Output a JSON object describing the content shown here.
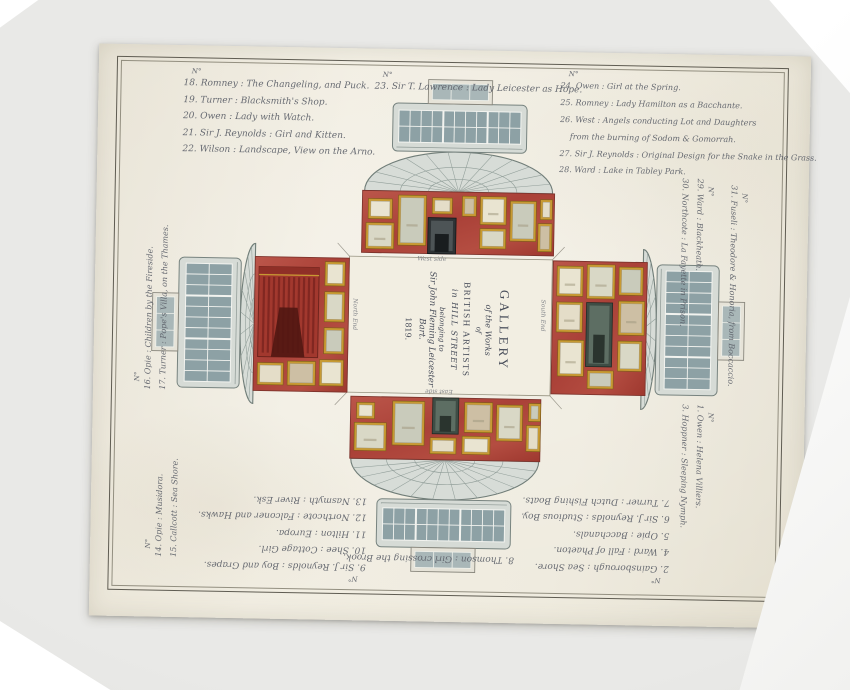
{
  "title": {
    "l1": "GALLERY",
    "l2": "of the Works",
    "l3": "of",
    "l4": "BRITISH ARTISTS",
    "l5": "in HILL STREET",
    "l6": "belonging to",
    "l7": "Sir John Fleming Leicester Bart.",
    "l8": "1819."
  },
  "captions": {
    "west": "West side",
    "east": "East side",
    "north": "North End",
    "south": "South End"
  },
  "catalogue": {
    "top_left": {
      "header": "N°",
      "items": [
        "18. Romney : The Changeling, and Puck.",
        "19. Turner : Blacksmith's Shop.",
        "20. Owen : Lady with Watch.",
        "21. Sir J. Reynolds : Girl and Kitten.",
        "22. Wilson : Landscape, View on the Arno."
      ]
    },
    "top_center": {
      "header": "N°",
      "items": [
        "23. Sir T. Lawrence : Lady Leicester as Hope."
      ]
    },
    "top_right": {
      "header": "N°",
      "items": [
        "24. Owen : Girl at the Spring.",
        "25. Romney : Lady Hamilton as a Bacchante.",
        "26. West : Angels conducting Lot and Daughters",
        "    from the burning of Sodom & Gomorrah.",
        "27. Sir J. Reynolds : Original Design for the Snake in the Grass.",
        "28. Ward : Lake in Tabley Park."
      ]
    },
    "left_upper": {
      "header": "N°",
      "items": [
        "16. Opie : Children by the Fireside.",
        "17. Turner : Pope's Villa, on the Thames."
      ]
    },
    "left_lower": {
      "header": "N°",
      "items": [
        "14. Opie : Musidora.",
        "15. Callcott : Sea Shore."
      ]
    },
    "right_upper": {
      "header": "N°",
      "items": [
        "29. Ward : Blackheath.",
        "30. Northcote : La Fayette in Prison."
      ]
    },
    "right_outer": {
      "header": "N°",
      "items": [
        "31. Fuseli : Theodore & Honoria, from Boccaccio."
      ]
    },
    "right_lower": {
      "header": "N°",
      "items": [
        "1. Owen : Helena Villiers.",
        "3. Hoppner : Sleeping Nymph."
      ]
    },
    "bottom_right": {
      "header": "N°",
      "items": [
        "2. Gainsborough : Sea Shore.",
        "4. Ward : Fall of Phaeton.",
        "5. Opie : Bacchanals.",
        "6. Sir J. Reynolds : Studious Boy.",
        "7. Turner : Dutch Fishing Boats."
      ]
    },
    "bottom_left": {
      "header": "N°",
      "items": [
        "9. Sir J. Reynolds : Boy and Grapes.",
        "10. Shee : Cottage Girl.",
        "11. Hilton : Europa.",
        "12. Northcote : Falconer and Hawks.",
        "13. Nasmyth : River Esk."
      ]
    },
    "bottom_center": {
      "items": [
        "8. Thomson : Girl crossing the Brook."
      ]
    }
  },
  "colors": {
    "paper": "#efebe0",
    "wall_red": "#b0483f",
    "curtain_red": "#a2382e",
    "frame_gold": "#c79a33",
    "canvas": "#eae5d3",
    "architecture": "#d6dbd6",
    "window_pane": "#8da1a5",
    "ink": "#5b5f68",
    "background": "#e3e3e1"
  },
  "plan": {
    "floor": [
      254,
      208,
      203,
      136
    ],
    "fold_lines": [
      [
        254,
        208,
        242,
        195
      ],
      [
        457,
        208,
        469,
        195
      ],
      [
        254,
        344,
        242,
        357
      ],
      [
        457,
        344,
        469,
        357
      ]
    ],
    "walls": {
      "west": {
        "rect": [
          266,
          142,
          192,
          62
        ],
        "frames": [
          [
            272,
            150,
            24,
            20
          ],
          [
            270,
            174,
            28,
            26
          ],
          [
            302,
            146,
            28,
            50
          ],
          [
            336,
            148,
            20,
            16
          ],
          [
            366,
            146,
            14,
            20
          ],
          [
            384,
            146,
            26,
            28
          ],
          [
            384,
            178,
            26,
            20
          ],
          [
            414,
            150,
            26,
            40
          ],
          [
            444,
            148,
            12,
            20
          ],
          [
            442,
            172,
            14,
            28
          ]
        ],
        "features": [
          {
            "type": "fireplace",
            "rect": [
              332,
              168,
              28,
              36
            ]
          }
        ]
      },
      "east": {
        "rect": [
          258,
          348,
          190,
          62
        ],
        "frames": [
          [
            264,
            354,
            18,
            16
          ],
          [
            262,
            374,
            32,
            28
          ],
          [
            300,
            352,
            32,
            44
          ],
          [
            338,
            388,
            26,
            16
          ],
          [
            372,
            352,
            28,
            30
          ],
          [
            370,
            386,
            28,
            18
          ],
          [
            404,
            354,
            26,
            36
          ],
          [
            436,
            352,
            12,
            18
          ],
          [
            434,
            374,
            14,
            26
          ]
        ],
        "features": [
          {
            "type": "door",
            "rect": [
              340,
              348,
              26,
              36
            ]
          }
        ]
      },
      "north": {
        "rect": [
          160,
          210,
          94,
          134
        ],
        "frames": [
          [
            230,
            214,
            20,
            24
          ],
          [
            230,
            244,
            20,
            30
          ],
          [
            230,
            280,
            20,
            26
          ],
          [
            164,
            316,
            26,
            22
          ],
          [
            194,
            314,
            28,
            24
          ],
          [
            226,
            312,
            24,
            26
          ]
        ],
        "features": [
          {
            "type": "curtain",
            "rect": [
              164,
              220,
              60,
              90
            ]
          }
        ]
      },
      "south": {
        "rect": [
          458,
          209,
          94,
          133
        ],
        "frames": [
          [
            462,
            214,
            26,
            30
          ],
          [
            492,
            212,
            28,
            34
          ],
          [
            524,
            214,
            24,
            28
          ],
          [
            462,
            250,
            26,
            30
          ],
          [
            524,
            248,
            26,
            34
          ],
          [
            464,
            288,
            26,
            36
          ],
          [
            524,
            288,
            24,
            30
          ],
          [
            494,
            318,
            26,
            18
          ]
        ],
        "features": [
          {
            "type": "door",
            "rect": [
              492,
              250,
              26,
              64
            ]
          }
        ]
      }
    },
    "arms": [
      {
        "name": "west-apse",
        "rotate": 0,
        "cx": 362,
        "cy": 142,
        "fan": [
          94,
          40
        ],
        "block": [
          134,
          48
        ],
        "stub": [
          64,
          24
        ]
      },
      {
        "name": "east-apse",
        "rotate": 180,
        "cx": 353,
        "cy": 410,
        "fan": [
          94,
          40
        ],
        "block": [
          134,
          48
        ],
        "stub": [
          64,
          24
        ]
      },
      {
        "name": "north-apse",
        "rotate": -90,
        "cx": 160,
        "cy": 277,
        "fan": [
          80,
          14
        ],
        "block": [
          130,
          62
        ],
        "stub": [
          58,
          26
        ]
      },
      {
        "name": "south-apse",
        "rotate": 90,
        "cx": 548,
        "cy": 276,
        "fan": [
          80,
          14
        ],
        "block": [
          130,
          62
        ],
        "stub": [
          58,
          26
        ]
      }
    ]
  }
}
